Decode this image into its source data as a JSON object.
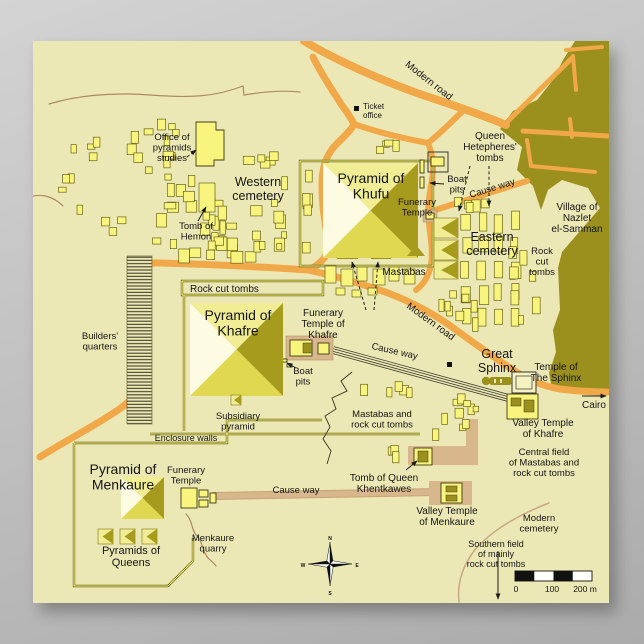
{
  "title": "Map of the Giza pyramid plateau",
  "colors": {
    "bg_top": "#d3d3d3",
    "bg_bottom": "#ababab",
    "poster": "#ece8b5",
    "ink": "#151515",
    "building": "#f8f47e",
    "building_stroke": "#6a6416",
    "olive": "#9b901e",
    "dark_face": "#a69b1c",
    "light_face": "#f0ed94",
    "pale_face": "#fdfce3",
    "mid_face": "#e0d850",
    "road": "#f0a848",
    "tan": "#d8b78c",
    "contour": "#ad8a62",
    "cemetery_arc": "#c9a883",
    "wall_dark": "#6a6416",
    "wall_light": "#f8f47e",
    "rail": "#3c3c2e"
  },
  "labels": [
    {
      "name": "label-office-of-pyramids-studies",
      "text": "Office of\npyramids\nstudies",
      "x": 172,
      "y": 140,
      "size": 9.5
    },
    {
      "name": "label-western-cemetery",
      "text": "Western\ncemetery",
      "x": 258,
      "y": 186,
      "size": 12.5
    },
    {
      "name": "label-tomb-of-hemon",
      "text": "Tomb of\nHemon",
      "x": 196,
      "y": 229,
      "size": 9.5
    },
    {
      "name": "label-ticket-office",
      "text": "Ticket\noffice",
      "x": 363,
      "y": 109,
      "size": 8,
      "anchor": "start"
    },
    {
      "name": "label-modern-road-top",
      "text": "Modern road",
      "x": 427,
      "y": 83,
      "size": 10,
      "rotate": 38
    },
    {
      "name": "label-queen-hetepheres-tombs",
      "text": "Queen\nHetepheres'\ntombs",
      "x": 490,
      "y": 139,
      "size": 10
    },
    {
      "name": "label-pyramid-of-khufu",
      "text": "Pyramid of\nKhufu",
      "x": 371,
      "y": 183,
      "size": 14
    },
    {
      "name": "label-boat-pits-ne",
      "text": "Boat\npits",
      "x": 457,
      "y": 182,
      "size": 9.5
    },
    {
      "name": "label-funerary-temple-khufu",
      "text": "Funerary\nTemple",
      "x": 417,
      "y": 205,
      "size": 9.5
    },
    {
      "name": "label-causeway-khufu",
      "text": "Cause way",
      "x": 493,
      "y": 191,
      "size": 9.5,
      "rotate": -17
    },
    {
      "name": "label-village-nazlet",
      "text": "Village of\nNazlet\nel-Samman",
      "x": 577,
      "y": 210,
      "size": 10
    },
    {
      "name": "label-eastern-cemetery",
      "text": "Eastern\ncemetery",
      "x": 492,
      "y": 241,
      "size": 12.5
    },
    {
      "name": "label-rock-cut-tombs-east",
      "text": "Rock\ncut\ntombs",
      "x": 542,
      "y": 254,
      "size": 9.5
    },
    {
      "name": "label-mastabas",
      "text": "Mastabas",
      "x": 404,
      "y": 275,
      "size": 10
    },
    {
      "name": "label-rock-cut-tombs-strip",
      "text": "Rock cut tombs",
      "x": 190,
      "y": 292,
      "size": 10,
      "anchor": "start"
    },
    {
      "name": "label-builders-quarters",
      "text": "Builders'\nquarters",
      "x": 100,
      "y": 339,
      "size": 9.5
    },
    {
      "name": "label-pyramid-of-khafre",
      "text": "Pyramid of\nKhafre",
      "x": 238,
      "y": 320,
      "size": 14
    },
    {
      "name": "label-funerary-temple-khafre",
      "text": "Funerary\nTemple of\nKhafre",
      "x": 323,
      "y": 316,
      "size": 10
    },
    {
      "name": "label-boat-pits-khafre",
      "text": "Boat\npits",
      "x": 303,
      "y": 374,
      "size": 9.5
    },
    {
      "name": "label-modern-road-mid",
      "text": "Modern road",
      "x": 429,
      "y": 324,
      "size": 10,
      "rotate": 36
    },
    {
      "name": "label-causeway-khafre",
      "text": "Cause way",
      "x": 394,
      "y": 354,
      "size": 9.5,
      "rotate": 13
    },
    {
      "name": "label-great-sphinx",
      "text": "Great\nSphinx",
      "x": 497,
      "y": 358,
      "size": 12.5
    },
    {
      "name": "label-temple-of-the-sphinx",
      "text": "Temple of\nThe Sphinx",
      "x": 556,
      "y": 370,
      "size": 10
    },
    {
      "name": "label-cairo",
      "text": "Cairo",
      "x": 594,
      "y": 408,
      "size": 10
    },
    {
      "name": "label-valley-temple-khafre",
      "text": "Valley Temple\nof Khafre",
      "x": 543,
      "y": 426,
      "size": 10
    },
    {
      "name": "label-subsidiary-pyramid",
      "text": "Subsidiary\npyramid",
      "x": 238,
      "y": 419,
      "size": 9.5
    },
    {
      "name": "label-mastabas-rock-cut",
      "text": "Mastabas and\nrock cut tombs",
      "x": 382,
      "y": 417,
      "size": 9.5
    },
    {
      "name": "label-enclosure-walls",
      "text": "Enclosure walls",
      "x": 186,
      "y": 441,
      "size": 9
    },
    {
      "name": "label-central-field",
      "text": "Central field\nof Mastabas and\nrock cut tombs",
      "x": 544,
      "y": 455,
      "size": 9.5
    },
    {
      "name": "label-pyramid-of-menkaure",
      "text": "Pyramid of\nMenkaure",
      "x": 123,
      "y": 474,
      "size": 14
    },
    {
      "name": "label-funerary-temple-menkaure",
      "text": "Funerary\nTemple",
      "x": 186,
      "y": 473,
      "size": 9.5
    },
    {
      "name": "label-causeway-menkaure",
      "text": "Cause way",
      "x": 296,
      "y": 493,
      "size": 9.5
    },
    {
      "name": "label-tomb-of-queen-khentkawes",
      "text": "Tomb of Queen\nKhentkawes",
      "x": 384,
      "y": 481,
      "size": 10
    },
    {
      "name": "label-valley-temple-menkaure",
      "text": "Valley Temple\nof Menkaure",
      "x": 447,
      "y": 514,
      "size": 10
    },
    {
      "name": "label-modern-cemetery",
      "text": "Modern\ncemetery",
      "x": 539,
      "y": 521,
      "size": 9.5
    },
    {
      "name": "label-pyramids-of-queens",
      "text": "Pyramids of\nQueens",
      "x": 131,
      "y": 554,
      "size": 11
    },
    {
      "name": "label-menkaure-quarry",
      "text": "Menkaure\nquarry",
      "x": 213,
      "y": 541,
      "size": 9.5
    },
    {
      "name": "label-southern-field",
      "text": "Southern field\nof mainly\nrock cut tombs",
      "x": 496,
      "y": 547,
      "size": 9
    },
    {
      "name": "label-scale-0",
      "text": "0",
      "x": 516,
      "y": 592,
      "size": 8.5
    },
    {
      "name": "label-scale-100",
      "text": "100",
      "x": 552,
      "y": 592,
      "size": 8.5
    },
    {
      "name": "label-scale-200",
      "text": "200 m",
      "x": 585,
      "y": 592,
      "size": 8.5
    },
    {
      "name": "compass-letter-n",
      "text": "N",
      "x": 330,
      "y": 540,
      "size": 5,
      "weight": "bold"
    },
    {
      "name": "compass-letter-e",
      "text": "E",
      "x": 357,
      "y": 567,
      "size": 5,
      "weight": "bold"
    },
    {
      "name": "compass-letter-s",
      "text": "S",
      "x": 330,
      "y": 595,
      "size": 5,
      "weight": "bold"
    },
    {
      "name": "compass-letter-w",
      "text": "W",
      "x": 303,
      "y": 567,
      "size": 5,
      "weight": "bold"
    }
  ],
  "clusters": [
    {
      "name": "western-cemetery-buildings",
      "x": 140,
      "y": 172,
      "w": 150,
      "h": 92,
      "n": 44,
      "seed": 7,
      "minw": 5,
      "maxw": 13,
      "minh": 6,
      "maxh": 14
    },
    {
      "name": "western-north-row",
      "x": 240,
      "y": 150,
      "w": 52,
      "h": 20,
      "n": 5,
      "seed": 11,
      "minw": 6,
      "maxw": 12,
      "minh": 6,
      "maxh": 10
    },
    {
      "name": "west-scatter",
      "x": 58,
      "y": 136,
      "w": 72,
      "h": 112,
      "n": 11,
      "seed": 3,
      "minw": 4,
      "maxw": 9,
      "minh": 5,
      "maxh": 11
    },
    {
      "name": "office-cluster",
      "x": 112,
      "y": 112,
      "w": 78,
      "h": 62,
      "n": 12,
      "seed": 5,
      "minw": 5,
      "maxw": 11,
      "minh": 6,
      "maxh": 12
    },
    {
      "name": "eastern-cemetery-grid",
      "type": "grid",
      "x": 462,
      "y": 213,
      "cols": 4,
      "rows": 5,
      "cw": 16,
      "rh": 24,
      "w": 10,
      "h": 19,
      "jitter": 2,
      "seed": 9
    },
    {
      "name": "eastern-extra",
      "x": 506,
      "y": 243,
      "w": 48,
      "h": 88,
      "n": 8,
      "seed": 13,
      "minw": 5,
      "maxw": 10,
      "minh": 8,
      "maxh": 18
    },
    {
      "name": "eastern-south",
      "x": 428,
      "y": 290,
      "w": 52,
      "h": 46,
      "n": 8,
      "seed": 15,
      "minw": 5,
      "maxw": 10,
      "minh": 7,
      "maxh": 14
    },
    {
      "name": "sphinx-sw-buildings",
      "x": 427,
      "y": 392,
      "w": 58,
      "h": 50,
      "n": 10,
      "seed": 17,
      "minw": 5,
      "maxw": 11,
      "minh": 5,
      "maxh": 13
    },
    {
      "name": "mid-scatter",
      "x": 352,
      "y": 381,
      "w": 82,
      "h": 18,
      "n": 5,
      "seed": 19,
      "minw": 5,
      "maxw": 9,
      "minh": 8,
      "maxh": 12
    },
    {
      "name": "khufu-west-row",
      "x": 302,
      "y": 166,
      "w": 11,
      "h": 94,
      "n": 6,
      "seed": 21,
      "minw": 6,
      "maxw": 9,
      "minh": 9,
      "maxh": 14
    },
    {
      "name": "khufu-north-row",
      "x": 352,
      "y": 138,
      "w": 55,
      "h": 16,
      "n": 4,
      "seed": 23,
      "minw": 6,
      "maxw": 10,
      "minh": 6,
      "maxh": 11
    },
    {
      "name": "khufu-ne-row",
      "x": 441,
      "y": 197,
      "w": 62,
      "h": 16,
      "n": 5,
      "seed": 25,
      "minw": 6,
      "maxw": 10,
      "minh": 8,
      "maxh": 13
    },
    {
      "name": "khentkawes-scatter",
      "x": 388,
      "y": 444,
      "w": 18,
      "h": 26,
      "n": 3,
      "seed": 27,
      "minw": 5,
      "maxw": 8,
      "minh": 8,
      "maxh": 14
    }
  ],
  "manual_rects": [
    {
      "x": 325,
      "y": 266,
      "w": 11,
      "h": 17
    },
    {
      "x": 341,
      "y": 269,
      "w": 12,
      "h": 17
    },
    {
      "x": 357,
      "y": 267,
      "w": 10,
      "h": 14
    },
    {
      "x": 373,
      "y": 269,
      "w": 12,
      "h": 16
    },
    {
      "x": 389,
      "y": 267,
      "w": 10,
      "h": 14
    },
    {
      "x": 404,
      "y": 269,
      "w": 11,
      "h": 15
    },
    {
      "x": 336,
      "y": 288,
      "w": 9,
      "h": 7
    },
    {
      "x": 352,
      "y": 290,
      "w": 9,
      "h": 7
    },
    {
      "x": 368,
      "y": 288,
      "w": 9,
      "h": 7
    },
    {
      "x": 199,
      "y": 183,
      "w": 16,
      "h": 29
    }
  ],
  "scale_bar": {
    "x": 515,
    "y": 571,
    "w": 77,
    "h": 10,
    "segments": 4
  },
  "compass": {
    "cx": 330,
    "cy": 564
  }
}
